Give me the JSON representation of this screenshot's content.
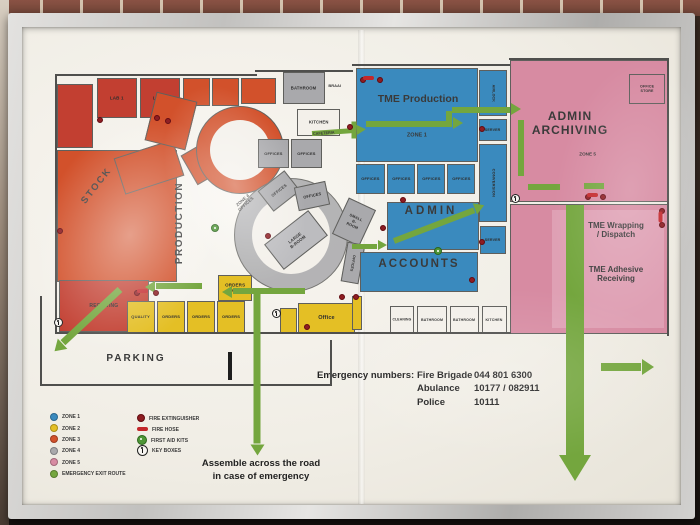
{
  "colors": {
    "z1": "#3a8abe",
    "z2": "#e4bf25",
    "z3": "#d2512b",
    "z3d": "#c23f31",
    "z4": "#a9a9ac",
    "z4l": "#bcbcbf",
    "z5": "#d78ba2",
    "z5l": "#dfa0b4",
    "green": "#74a63e",
    "paper": "#f3f0ea",
    "ext": "#8e1d22",
    "hose": "#c3272b"
  },
  "legend": {
    "zones": [
      {
        "label": "ZONE 1",
        "c": "z1"
      },
      {
        "label": "ZONE 2",
        "c": "z2"
      },
      {
        "label": "ZONE 3",
        "c": "z3"
      },
      {
        "label": "ZONE 4",
        "c": "z4"
      },
      {
        "label": "ZONE 5",
        "c": "z5"
      },
      {
        "label": "EMERGENCY EXIT ROUTE",
        "c": "green"
      }
    ],
    "symbols": [
      {
        "label": "FIRE EXTINGUISHER",
        "type": "extinguisher"
      },
      {
        "label": "FIRE HOSE",
        "type": "hose"
      },
      {
        "label": "FIRST AID KITS",
        "type": "firstaid"
      },
      {
        "label": "KEY BOXES",
        "type": "keybox"
      }
    ]
  },
  "emergency": {
    "heading": "Emergency numbers:",
    "rows": [
      {
        "name": "Fire Brigade",
        "number": "044 801 6300"
      },
      {
        "name": "Abulance",
        "number": "10177 / 082911"
      },
      {
        "name": "Police",
        "number": "10111"
      }
    ]
  },
  "assembly_note": {
    "line1": "Assemble across the road",
    "line2": "in case of emergency"
  },
  "map": {
    "rooms": [
      {
        "n": "stock-area",
        "x": 57,
        "y": 150,
        "w": 120,
        "h": 132,
        "c": "z3"
      },
      {
        "n": "store-room",
        "x": 57,
        "y": 84,
        "w": 36,
        "h": 64,
        "c": "z3d"
      },
      {
        "n": "lab-1",
        "t": "LAB 1",
        "x": 97,
        "y": 78,
        "w": 40,
        "h": 40,
        "c": "z3d",
        "fs": 4.5
      },
      {
        "n": "lab-2",
        "t": "LAB 2",
        "x": 140,
        "y": 78,
        "w": 40,
        "h": 40,
        "c": "z3d",
        "fs": 4.5
      },
      {
        "n": "production-room-a",
        "x": 183,
        "y": 78,
        "w": 27,
        "h": 28,
        "c": "z3"
      },
      {
        "n": "production-room-b",
        "x": 212,
        "y": 78,
        "w": 27,
        "h": 28,
        "c": "z3"
      },
      {
        "n": "production-room-c",
        "x": 241,
        "y": 78,
        "w": 35,
        "h": 26,
        "c": "z3"
      },
      {
        "n": "machine-wedge-a",
        "x": 118,
        "y": 148,
        "w": 62,
        "h": 38,
        "c": "z3",
        "rot": -18
      },
      {
        "n": "machine-wedge-b",
        "x": 150,
        "y": 96,
        "w": 42,
        "h": 50,
        "c": "z3",
        "rot": 14
      },
      {
        "n": "machine-wedge-c",
        "x": 186,
        "y": 142,
        "w": 46,
        "h": 34,
        "c": "z3",
        "rot": -30
      },
      {
        "n": "machine-arc-outer",
        "x": 196,
        "y": 106,
        "w": 88,
        "h": 88,
        "c": "z3",
        "rad": "50%"
      },
      {
        "n": "machine-arc-inner",
        "x": 210,
        "y": 120,
        "w": 60,
        "h": 60,
        "c": "paper",
        "rad": "50%",
        "nb": true
      },
      {
        "n": "receiving",
        "t": "RECEIVING",
        "x": 59,
        "y": 280,
        "w": 90,
        "h": 52,
        "c": "z3d",
        "fs": 5
      },
      {
        "n": "corridor-ring-outer",
        "x": 234,
        "y": 178,
        "w": 114,
        "h": 114,
        "c": "z4",
        "rad": "50%",
        "op": 0.85
      },
      {
        "n": "corridor-ring-inner",
        "x": 252,
        "y": 196,
        "w": 78,
        "h": 78,
        "c": "paper",
        "rad": "50%",
        "nb": true
      },
      {
        "n": "bathroom-top",
        "t": "BATHROOM",
        "x": 283,
        "y": 72,
        "w": 42,
        "h": 32,
        "c": "z4",
        "fs": 4.2
      },
      {
        "n": "kitchen-top",
        "t": "KITCHEN",
        "x": 297,
        "y": 109,
        "w": 43,
        "h": 27,
        "c": "paper",
        "fs": 4.2
      },
      {
        "n": "offices-gray-a",
        "t": "OFFICES",
        "x": 258,
        "y": 139,
        "w": 31,
        "h": 29,
        "c": "z4",
        "fs": 4
      },
      {
        "n": "offices-gray-b",
        "t": "OFFICES",
        "x": 291,
        "y": 139,
        "w": 31,
        "h": 29,
        "c": "z4",
        "fs": 4
      },
      {
        "n": "offices-gray-c",
        "t": "OFFICES",
        "x": 262,
        "y": 178,
        "w": 34,
        "h": 26,
        "c": "z4",
        "rot": -38,
        "fs": 4
      },
      {
        "n": "offices-gray-d",
        "t": "OFFICES",
        "x": 296,
        "y": 184,
        "w": 32,
        "h": 24,
        "c": "z4",
        "rot": -12,
        "fs": 4
      },
      {
        "n": "large-boardroom",
        "t": "LARGE\nB-ROOM",
        "x": 268,
        "y": 224,
        "w": 56,
        "h": 32,
        "c": "z4l",
        "rot": -38,
        "fs": 4.2
      },
      {
        "n": "small-boardroom",
        "t": "SMALL\nB-ROOM",
        "x": 339,
        "y": 202,
        "w": 30,
        "h": 40,
        "c": "z4",
        "rot": 25,
        "fs": 3.8
      },
      {
        "n": "offices-gray-e",
        "t": "OFFICES",
        "x": 344,
        "y": 243,
        "w": 18,
        "h": 40,
        "c": "z4",
        "rot": 10,
        "fs": 3.6,
        "vert": true
      },
      {
        "n": "quality",
        "t": "QUALITY",
        "x": 127,
        "y": 301,
        "w": 28,
        "h": 32,
        "c": "z2",
        "fs": 4
      },
      {
        "n": "orders-1",
        "t": "ORDERS",
        "x": 157,
        "y": 301,
        "w": 28,
        "h": 32,
        "c": "z2",
        "fs": 4
      },
      {
        "n": "orders-2",
        "t": "ORDERS",
        "x": 187,
        "y": 301,
        "w": 28,
        "h": 32,
        "c": "z2",
        "fs": 4
      },
      {
        "n": "orders-3",
        "t": "ORDERS",
        "x": 217,
        "y": 301,
        "w": 28,
        "h": 32,
        "c": "z2",
        "fs": 4
      },
      {
        "n": "orders-zone2",
        "t": "ORDERS\nZONE 2",
        "x": 218,
        "y": 275,
        "w": 34,
        "h": 26,
        "c": "z2",
        "fs": 4.5
      },
      {
        "n": "office-annex",
        "x": 280,
        "y": 308,
        "w": 17,
        "h": 25,
        "c": "z2"
      },
      {
        "n": "office",
        "t": "Office",
        "x": 298,
        "y": 303,
        "w": 57,
        "h": 30,
        "c": "z2",
        "fs": 5.5
      },
      {
        "n": "yellow-store",
        "x": 352,
        "y": 296,
        "w": 10,
        "h": 34,
        "c": "z2"
      },
      {
        "n": "tme-production-hall",
        "x": 356,
        "y": 68,
        "w": 122,
        "h": 94,
        "c": "z1"
      },
      {
        "n": "offices-blue-a",
        "t": "OFFICES",
        "x": 356,
        "y": 164,
        "w": 29,
        "h": 30,
        "c": "z1",
        "fs": 4
      },
      {
        "n": "offices-blue-b",
        "t": "OFFICES",
        "x": 387,
        "y": 164,
        "w": 28,
        "h": 30,
        "c": "z1",
        "fs": 4
      },
      {
        "n": "offices-blue-c",
        "t": "OFFICES",
        "x": 417,
        "y": 164,
        "w": 28,
        "h": 30,
        "c": "z1",
        "fs": 4
      },
      {
        "n": "offices-blue-d",
        "t": "OFFICES",
        "x": 447,
        "y": 164,
        "w": 28,
        "h": 30,
        "c": "z1",
        "fs": 4
      },
      {
        "n": "airlock",
        "t": "AIRLOCK",
        "x": 479,
        "y": 70,
        "w": 28,
        "h": 46,
        "c": "z1",
        "fs": 3.6,
        "vert": true
      },
      {
        "n": "server-room-a",
        "t": "SERVER",
        "x": 479,
        "y": 119,
        "w": 28,
        "h": 22,
        "c": "z1",
        "fs": 3.6
      },
      {
        "n": "conversion",
        "t": "CONVERSION",
        "x": 479,
        "y": 144,
        "w": 28,
        "h": 78,
        "c": "z1",
        "fs": 4,
        "vert": true
      },
      {
        "n": "admin-room",
        "x": 387,
        "y": 202,
        "w": 92,
        "h": 48,
        "c": "z1"
      },
      {
        "n": "accounts-room",
        "x": 360,
        "y": 252,
        "w": 118,
        "h": 40,
        "c": "z1"
      },
      {
        "n": "server-room-b",
        "t": "SERVER",
        "x": 480,
        "y": 226,
        "w": 26,
        "h": 28,
        "c": "z1",
        "fs": 3.6
      },
      {
        "n": "cleaning",
        "t": "CLEANING",
        "x": 390,
        "y": 306,
        "w": 24,
        "h": 28,
        "c": "paper",
        "fs": 3.4
      },
      {
        "n": "bathroom-a",
        "t": "BATHROOM",
        "x": 417,
        "y": 306,
        "w": 30,
        "h": 28,
        "c": "paper",
        "fs": 3.6
      },
      {
        "n": "bathroom-b",
        "t": "BATHROOM",
        "x": 450,
        "y": 306,
        "w": 29,
        "h": 28,
        "c": "paper",
        "fs": 3.6
      },
      {
        "n": "kitchen-b",
        "t": "KITCHEN",
        "x": 482,
        "y": 306,
        "w": 25,
        "h": 28,
        "c": "paper",
        "fs": 3.6
      },
      {
        "n": "admin-archiving-room",
        "x": 510,
        "y": 60,
        "w": 158,
        "h": 142,
        "c": "z5"
      },
      {
        "n": "office-store",
        "t": "OFFICE\nSTORE",
        "x": 629,
        "y": 74,
        "w": 36,
        "h": 30,
        "c": "z5",
        "fs": 3.6
      },
      {
        "n": "tme-wrapping-room",
        "x": 510,
        "y": 204,
        "w": 158,
        "h": 130,
        "c": "z5"
      },
      {
        "n": "wrapping-inner",
        "x": 552,
        "y": 210,
        "w": 112,
        "h": 118,
        "c": "z5l",
        "nb": true
      }
    ],
    "labels": [
      {
        "n": "stock-label",
        "t": "STOCK",
        "x": 62,
        "y": 178,
        "w": 70,
        "h": 16,
        "fs": 9.5,
        "rot": -52,
        "ls": 2
      },
      {
        "n": "production-label",
        "t": "PRODUCTION",
        "x": 130,
        "y": 216,
        "w": 100,
        "h": 14,
        "fs": 10,
        "rot": -90,
        "ls": 1.5
      },
      {
        "n": "zone4-offices-label",
        "t": "ZONE 4\nOFFICES",
        "x": 224,
        "y": 194,
        "w": 40,
        "h": 16,
        "fs": 4.4,
        "rot": -42
      },
      {
        "n": "braai-label",
        "t": "BRAAI",
        "x": 320,
        "y": 82,
        "w": 30,
        "h": 8,
        "fs": 4
      },
      {
        "n": "cafeteria-label",
        "t": "CAFETERIA",
        "x": 304,
        "y": 129,
        "w": 40,
        "h": 8,
        "fs": 3.8,
        "rot": -4
      },
      {
        "n": "tme-production-label",
        "t": "TME Production",
        "x": 362,
        "y": 92,
        "w": 112,
        "h": 14,
        "fs": 10.5,
        "bold": true
      },
      {
        "n": "zone1-label",
        "t": "ZONE 1",
        "x": 394,
        "y": 131,
        "w": 46,
        "h": 9,
        "fs": 5.5
      },
      {
        "n": "admin-label",
        "t": "ADMIN",
        "x": 392,
        "y": 205,
        "w": 78,
        "h": 14,
        "fs": 11.5,
        "ls": 3
      },
      {
        "n": "accounts-label",
        "t": "ACCOUNTS",
        "x": 366,
        "y": 258,
        "w": 106,
        "h": 14,
        "fs": 11.5,
        "ls": 2
      },
      {
        "n": "admin-archiving-label",
        "t": "ADMIN\nARCHIVING",
        "x": 514,
        "y": 108,
        "w": 112,
        "h": 30,
        "fs": 12,
        "ls": 1
      },
      {
        "n": "zone5-label",
        "t": "ZONE 5",
        "x": 568,
        "y": 150,
        "w": 40,
        "h": 8,
        "fs": 4.6
      },
      {
        "n": "tme-wrapping-label",
        "t": "TME Wrapping\n/ Dispatch",
        "x": 578,
        "y": 218,
        "w": 76,
        "h": 24,
        "fs": 8
      },
      {
        "n": "tme-adhesive-label",
        "t": "TME Adhesive\nReceiving",
        "x": 578,
        "y": 262,
        "w": 76,
        "h": 24,
        "fs": 8
      },
      {
        "n": "parking-label",
        "t": "PARKING",
        "x": 98,
        "y": 352,
        "w": 76,
        "h": 14,
        "fs": 10,
        "ls": 2
      }
    ],
    "walls": [
      {
        "x": 55,
        "y": 74,
        "w": 202,
        "h": 2
      },
      {
        "x": 255,
        "y": 70,
        "w": 98,
        "h": 2
      },
      {
        "x": 352,
        "y": 64,
        "w": 158,
        "h": 2
      },
      {
        "x": 509,
        "y": 58,
        "w": 160,
        "h": 2
      },
      {
        "x": 667,
        "y": 58,
        "w": 2,
        "h": 278
      },
      {
        "x": 55,
        "y": 74,
        "w": 2,
        "h": 260
      },
      {
        "x": 55,
        "y": 332,
        "w": 456,
        "h": 2
      },
      {
        "x": 40,
        "y": 296,
        "w": 2,
        "h": 90
      },
      {
        "x": 40,
        "y": 384,
        "w": 292,
        "h": 2
      },
      {
        "x": 330,
        "y": 340,
        "w": 2,
        "h": 46
      },
      {
        "x": 228,
        "y": 352,
        "w": 4,
        "h": 28,
        "dark": true
      }
    ],
    "arrows": [
      {
        "n": "exit-arrow-orders",
        "x": 202,
        "y": 286,
        "len": 46,
        "th": 6,
        "rot": 180,
        "head": true
      },
      {
        "n": "exit-arrow-receiving",
        "x": 120,
        "y": 289,
        "len": 78,
        "th": 7,
        "rot": 137,
        "head": true
      },
      {
        "n": "exit-arrow-mid",
        "x": 305,
        "y": 291,
        "len": 72,
        "th": 6,
        "rot": 180,
        "head": true
      },
      {
        "n": "exit-arrow-center-south",
        "x": 257,
        "y": 288,
        "len": 155,
        "th": 7,
        "rot": 90,
        "head": true
      },
      {
        "n": "exit-arrow-tme",
        "x": 366,
        "y": 124,
        "len": 86,
        "th": 6,
        "rot": 0,
        "head": true
      },
      {
        "n": "exit-arrow-corridor",
        "x": 452,
        "y": 110,
        "len": 58,
        "th": 6,
        "rot": 0,
        "head": true
      },
      {
        "n": "exit-elbow-corridor",
        "x": 449,
        "y": 127,
        "len": 16,
        "th": 6,
        "rot": -90,
        "head": false
      },
      {
        "n": "exit-arrow-cafeteria",
        "x": 312,
        "y": 133,
        "len": 44,
        "th": 5,
        "rot": -4,
        "head": true
      },
      {
        "n": "exit-arrow-admin",
        "x": 394,
        "y": 241,
        "len": 86,
        "th": 6,
        "rot": -21,
        "head": true
      },
      {
        "n": "exit-arrow-accounts",
        "x": 352,
        "y": 246,
        "len": 25,
        "th": 5,
        "rot": 0,
        "head": true
      },
      {
        "n": "exit-arrow-dispatch-south",
        "x": 575,
        "y": 205,
        "len": 250,
        "th": 18,
        "rot": 90,
        "head": true,
        "hs": 26
      },
      {
        "n": "exit-arrow-east",
        "x": 601,
        "y": 367,
        "len": 40,
        "th": 8,
        "rot": 0,
        "head": true
      },
      {
        "n": "exit-route-pink-a",
        "x": 521,
        "y": 120,
        "len": 56,
        "th": 6,
        "rot": 90,
        "head": false
      },
      {
        "n": "exit-route-pink-b",
        "x": 528,
        "y": 187,
        "len": 32,
        "th": 6,
        "rot": 0,
        "head": false
      },
      {
        "n": "exit-route-pink-c",
        "x": 584,
        "y": 186,
        "len": 20,
        "th": 6,
        "rot": 0,
        "head": false
      },
      {
        "n": "exit-route-tme-edge",
        "x": 354,
        "y": 121,
        "len": 17,
        "th": 5,
        "rot": 90,
        "head": false
      }
    ],
    "markers": {
      "extinguishers": [
        [
          100,
          120
        ],
        [
          157,
          118
        ],
        [
          168,
          121
        ],
        [
          350,
          127
        ],
        [
          363,
          80
        ],
        [
          380,
          80
        ],
        [
          482,
          129
        ],
        [
          482,
          242
        ],
        [
          383,
          228
        ],
        [
          403,
          200
        ],
        [
          472,
          280
        ],
        [
          268,
          236
        ],
        [
          307,
          327
        ],
        [
          342,
          297
        ],
        [
          356,
          297
        ],
        [
          588,
          197
        ],
        [
          603,
          197
        ],
        [
          662,
          211
        ],
        [
          662,
          225
        ],
        [
          137,
          293
        ],
        [
          156,
          293
        ],
        [
          60,
          231
        ]
      ],
      "hoses": [
        {
          "x": 142,
          "y": 291
        },
        {
          "x": 368,
          "y": 78
        },
        {
          "x": 592,
          "y": 195
        },
        {
          "x": 660,
          "y": 217,
          "rot": 90
        }
      ],
      "firstaid": [
        [
          215,
          228
        ],
        [
          438,
          251
        ]
      ],
      "keyboxes": [
        [
          58,
          322
        ],
        [
          276,
          313
        ],
        [
          515,
          198
        ]
      ]
    }
  }
}
